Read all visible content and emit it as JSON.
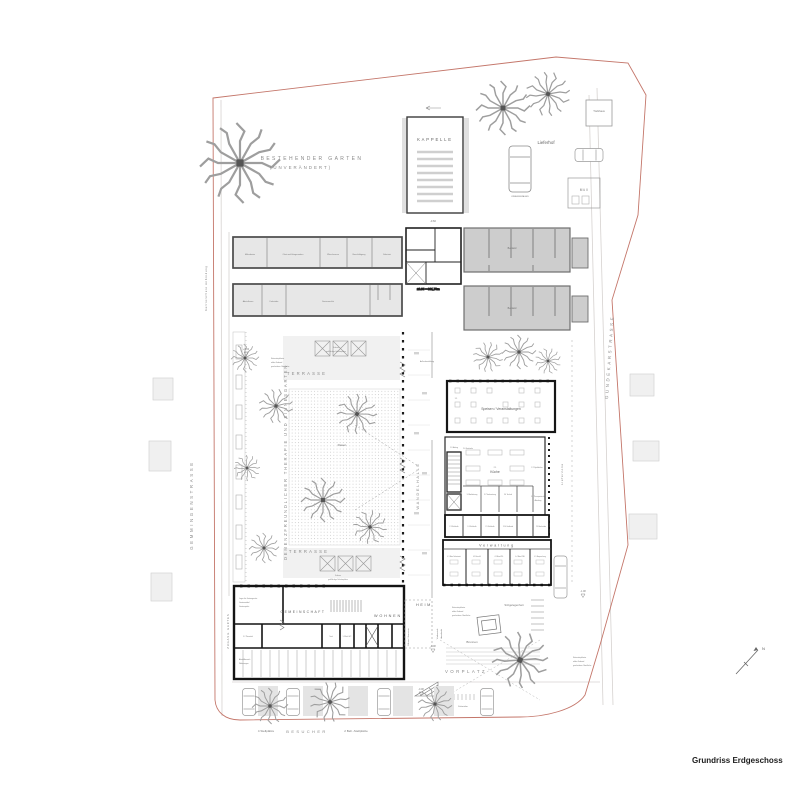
{
  "doc": {
    "title": "Grundriss Erdgeschoss",
    "north": "N"
  },
  "streets": {
    "left": "GEMMINGENSTRASSE",
    "right": "GUNDEKARSTRASSE",
    "path": "barrierefreie Anbindung"
  },
  "garden_existing": {
    "line1": "BESTEHENDER GARTEN",
    "line2": "(UNVERÄNDERT)"
  },
  "chapel": {
    "name": "KAPPELLE",
    "level": "-0.60"
  },
  "delivery": {
    "yard": "Lieferhof",
    "trafo": "Trafohaus",
    "waste": "M ü l l",
    "ambulance": "KRANKENWAGEN",
    "zone": "Lieferzone"
  },
  "existing_buildings": {
    "label1": "Bestand",
    "label2": "Bestand"
  },
  "north_wing": {
    "rooms_a": [
      "Mähroboter",
      "Obst und Hängematten",
      "Wäscheraum",
      "Beschäftigung",
      "Sakristei"
    ],
    "rooms_b": [
      "Abstellraum",
      "Fahrräder",
      "Seniorenclub"
    ]
  },
  "levels": {
    "datum": "±0.00 = 391,70m",
    "l1": "+0.00",
    "l2": "-0.08",
    "l3": "-0.08",
    "l4": "-1.08"
  },
  "paving": {
    "l1": "Natursteinpflaster",
    "l2": "wilder Verband",
    "l3": "geschnittene Oberfläche"
  },
  "garden": {
    "title": "DEMENZFREUNDLICHER THERAPIE UND SINNESGARTEN",
    "lawn": "Rasen",
    "terrace_upper": "TERRASSE",
    "terrace_lower": "TERRASSE",
    "shade1": "Schirme",
    "shade2": "großflächige Schattenplätze",
    "access": "ZUGANG GARTEN"
  },
  "hall": {
    "name": "WANDELHALLE",
    "seating_note": "Außenbestuhlung"
  },
  "dining": {
    "no": "1.1",
    "name": "Speisen / Veranstaltungen"
  },
  "kitchen": {
    "no": "2.1",
    "name": "Küche",
    "scullery": "2.2 Spülküche",
    "drinks": "2.6 Getränke",
    "lift": "1.2 Aufzug",
    "cold": [
      "2.3 Kühlzelle",
      "2.4 Kühlzelle",
      "2.5 Kühlzelle",
      "2.10 Umkleide",
      "2.9 Backstube"
    ],
    "prep": [
      "3.1 Anlieferung",
      "3.2 Vorbereitung",
      "3.4 Technik"
    ],
    "therapy1": "3.8 Therapeutische",
    "therapy2": "Abteilung"
  },
  "admin": {
    "name": "Verwaltung",
    "offices": [
      "4.1 Büro Sekretariat",
      "4.2 Büro HL",
      "4.3 Büro PDL",
      "4.4 Büro WBL",
      "4.5 Besprechung"
    ]
  },
  "community": {
    "name": "GEMEINSCHAFT",
    "living": "WOHNEN",
    "entry": "HEIM",
    "storage1": "Lager für Gartengeräte",
    "storage2": "Gartenmöbel",
    "storage3": "Gartenspiele",
    "cleaning": "5.2 Putzmittel",
    "tank": "Tank",
    "wc": "5.3 Beh.-WC",
    "parking1": "Abstellbereich",
    "parking2": "Wohnungen",
    "service": "Müllraum / Hausmeister"
  },
  "forecourt": {
    "name": "VORPLATZ",
    "canopy1": "Vorbereich",
    "canopy2": "überdacht",
    "fountain": "Brunnen",
    "seating": "Sitzgelegenheit",
    "bikes": "Fahrräder"
  },
  "parking": {
    "spots1": "4 Stellplätze",
    "visitors": "BESUCHER",
    "spots2": "2 Beh.-Stellplätze"
  }
}
